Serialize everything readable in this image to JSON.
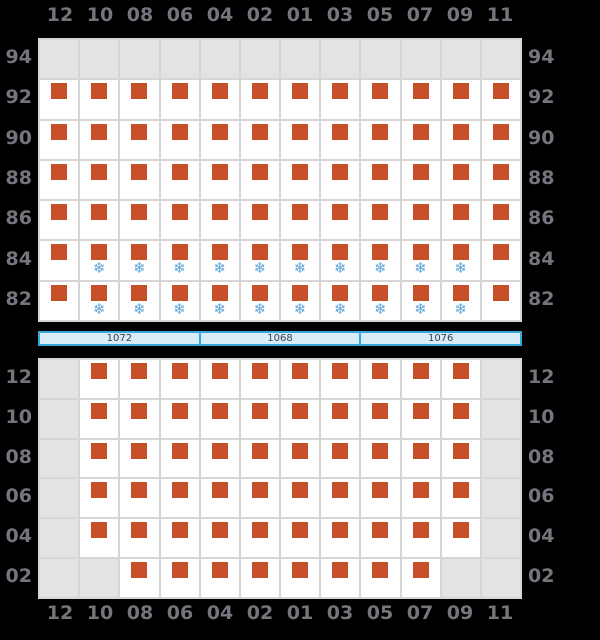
{
  "colors": {
    "background": "#000000",
    "label": "#75757d",
    "grid_line": "#d6d6d9",
    "cell_empty": "#e3e3e6",
    "cell_filled": "#ffffff",
    "square": "#c85028",
    "snowflake": "#5ea4d8",
    "bar_fill": "#d8edf9",
    "bar_border": "#38a5db",
    "bar_text": "#3e3e46"
  },
  "icons": {
    "snowflake": "❄"
  },
  "cell_codes": {
    "E": "empty",
    "S": "square",
    "F": "square_snowflake"
  },
  "top_axis": {
    "labels": [
      "12",
      "10",
      "08",
      "06",
      "04",
      "02",
      "01",
      "03",
      "05",
      "07",
      "09",
      "11"
    ]
  },
  "upper_grid": {
    "row_labels": [
      "94",
      "92",
      "90",
      "88",
      "86",
      "84",
      "82"
    ],
    "rows": [
      [
        "E",
        "E",
        "E",
        "E",
        "E",
        "E",
        "E",
        "E",
        "E",
        "E",
        "E",
        "E"
      ],
      [
        "S",
        "S",
        "S",
        "S",
        "S",
        "S",
        "S",
        "S",
        "S",
        "S",
        "S",
        "S"
      ],
      [
        "S",
        "S",
        "S",
        "S",
        "S",
        "S",
        "S",
        "S",
        "S",
        "S",
        "S",
        "S"
      ],
      [
        "S",
        "S",
        "S",
        "S",
        "S",
        "S",
        "S",
        "S",
        "S",
        "S",
        "S",
        "S"
      ],
      [
        "S",
        "S",
        "S",
        "S",
        "S",
        "S",
        "S",
        "S",
        "S",
        "S",
        "S",
        "S"
      ],
      [
        "S",
        "F",
        "F",
        "F",
        "F",
        "F",
        "F",
        "F",
        "F",
        "F",
        "F",
        "S"
      ],
      [
        "S",
        "F",
        "F",
        "F",
        "F",
        "F",
        "F",
        "F",
        "F",
        "F",
        "F",
        "S"
      ]
    ]
  },
  "summary_bar": {
    "segments": [
      "1072",
      "1068",
      "1076"
    ]
  },
  "lower_grid": {
    "row_labels": [
      "12",
      "10",
      "08",
      "06",
      "04",
      "02"
    ],
    "rows": [
      [
        "E",
        "S",
        "S",
        "S",
        "S",
        "S",
        "S",
        "S",
        "S",
        "S",
        "S",
        "E"
      ],
      [
        "E",
        "S",
        "S",
        "S",
        "S",
        "S",
        "S",
        "S",
        "S",
        "S",
        "S",
        "E"
      ],
      [
        "E",
        "S",
        "S",
        "S",
        "S",
        "S",
        "S",
        "S",
        "S",
        "S",
        "S",
        "E"
      ],
      [
        "E",
        "S",
        "S",
        "S",
        "S",
        "S",
        "S",
        "S",
        "S",
        "S",
        "S",
        "E"
      ],
      [
        "E",
        "S",
        "S",
        "S",
        "S",
        "S",
        "S",
        "S",
        "S",
        "S",
        "S",
        "E"
      ],
      [
        "E",
        "E",
        "S",
        "S",
        "S",
        "S",
        "S",
        "S",
        "S",
        "S",
        "E",
        "E"
      ]
    ]
  },
  "bottom_axis": {
    "labels": [
      "12",
      "10",
      "08",
      "06",
      "04",
      "02",
      "01",
      "03",
      "05",
      "07",
      "09",
      "11"
    ]
  }
}
